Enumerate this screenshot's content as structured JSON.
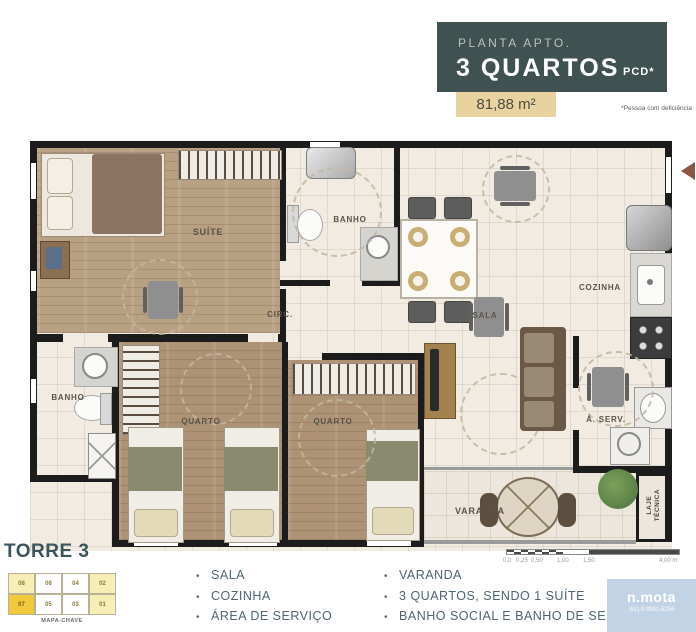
{
  "header": {
    "subtitle": "PLANTA APTO.",
    "title": "3 QUARTOS",
    "title_suffix": "PCD*",
    "area": "81,88 m²",
    "footnote": "*Pessoa com deficiência"
  },
  "plan": {
    "rooms": {
      "suite": "SUÍTE",
      "banho_social": "BANHO",
      "circ": "CIRC.",
      "sala": "SALA",
      "cozinha": "COZINHA",
      "quarto1": "QUARTO",
      "quarto2": "QUARTO",
      "banho_servico": "BANHO",
      "area_servico": "Á. SERV.",
      "varanda": "VARANDA",
      "laje_tecnica": "LAJE TÉCNICA"
    }
  },
  "footer": {
    "tower": "TORRE 3",
    "map_key": {
      "label": "MAPA-CHAVE",
      "top_row": [
        "08",
        "06",
        "04",
        "02"
      ],
      "bottom_row": [
        "07",
        "05",
        "03",
        "01"
      ],
      "highlighted_unit": "07"
    },
    "features_left": [
      "SALA",
      "COZINHA",
      "ÁREA DE SERVIÇO"
    ],
    "features_right": [
      "VARANDA",
      "3 QUARTOS, SENDO 1 SUÍTE",
      "BANHO SOCIAL E BANHO DE SERVIÇO"
    ],
    "scale_labels": [
      "0,0",
      "0,25",
      "0,50",
      "1,00",
      "1,50",
      "4,00 m"
    ],
    "logo": {
      "name": "n.mota",
      "phone": "(61) 9 8981-8256"
    }
  },
  "colors": {
    "header_bg": "#3F5150",
    "area_badge_bg": "#E7D2A0",
    "accent_text": "#4E6570",
    "wall": "#1C1C1C",
    "wood_floor": "#AD9276",
    "ceramic_floor": "#F1EBE2",
    "map_highlight": "#F0C93C",
    "map_light": "#F7EDB6",
    "logo_bg": "#C2D3E5",
    "entry_arrow": "#8A5743"
  }
}
